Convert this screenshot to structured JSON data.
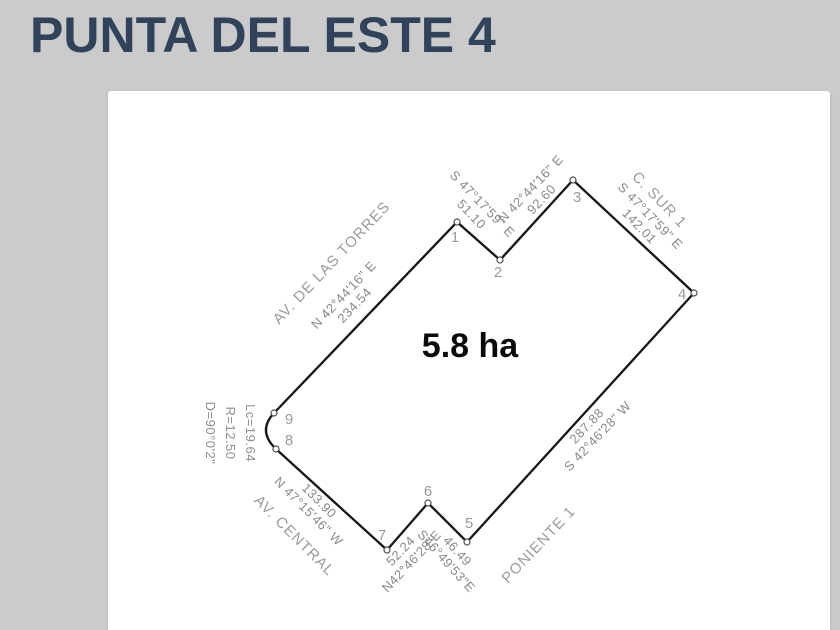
{
  "page": {
    "title": "PUNTA DEL ESTE 4"
  },
  "colors": {
    "background": "#cbcbcc",
    "card": "#ffffff",
    "title_text": "#30435a",
    "boundary_line": "#161616",
    "dimension_text": "#8a8a8a",
    "street_text": "#9c9c9c",
    "area_text": "#0a0a0a"
  },
  "survey": {
    "area_label": "5.8 ha",
    "vertex_labels": [
      "1",
      "2",
      "3",
      "4",
      "5",
      "6",
      "7",
      "8",
      "9"
    ],
    "sides": [
      {
        "side": "9-1",
        "line1": "N 42°44'16\" E",
        "line2": "234.54"
      },
      {
        "side": "1-2",
        "line1": "S 47°17'59\" E",
        "line2": "51.10"
      },
      {
        "side": "2-3",
        "line1": "N 42°44'16\" E",
        "line2": "92.60"
      },
      {
        "side": "3-4",
        "line1": "S 47°17'59\" E",
        "line2": "142.01"
      },
      {
        "side": "4-5",
        "line1": "287.88",
        "line2": "S 42°46'28\" W"
      },
      {
        "side": "6-5",
        "line1": "46.49",
        "line2": "S46°49'53\"E"
      },
      {
        "side": "7-6",
        "line1": "52.24",
        "line2": "N42°46'28\"E"
      },
      {
        "side": "7-8",
        "line1": "133.90",
        "line2": "N 47°15'46\" W"
      }
    ],
    "streets": [
      {
        "name": "AV. DE LAS TORRES"
      },
      {
        "name": "C. SUR 1"
      },
      {
        "name": "PONIENTE 1"
      },
      {
        "name": "AV. CENTRAL"
      }
    ],
    "curve": {
      "line1": "Lc=19.64",
      "line2": "R=12.50",
      "line3": "D=90°0'2\""
    }
  }
}
